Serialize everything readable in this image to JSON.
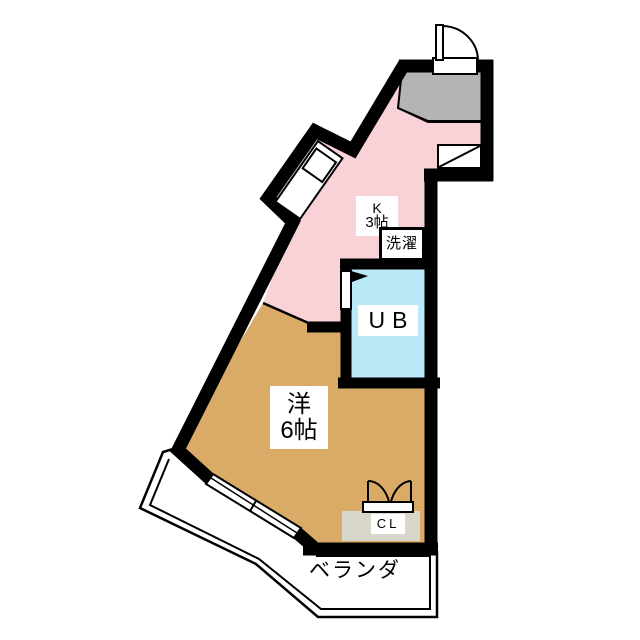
{
  "floorplan": {
    "type": "apartment-floorplan",
    "rooms": {
      "kitchen": {
        "label": "K",
        "size": "3帖"
      },
      "laundry": {
        "label": "洗濯"
      },
      "unit_bath": {
        "label": "UB"
      },
      "western_room": {
        "label": "洋",
        "size": "6帖"
      },
      "closet": {
        "label": "CL"
      },
      "veranda": {
        "label": "ベランダ"
      }
    },
    "colors": {
      "kitchen_floor": "#f8d2d7",
      "western_room_floor": "#d9ab66",
      "unit_bath_floor": "#bce9f8",
      "genkan_floor": "#b4b4b4",
      "closet_floor": "#d9d6ca",
      "wall": "#000000",
      "fixture_fill": "#ffffff"
    }
  }
}
